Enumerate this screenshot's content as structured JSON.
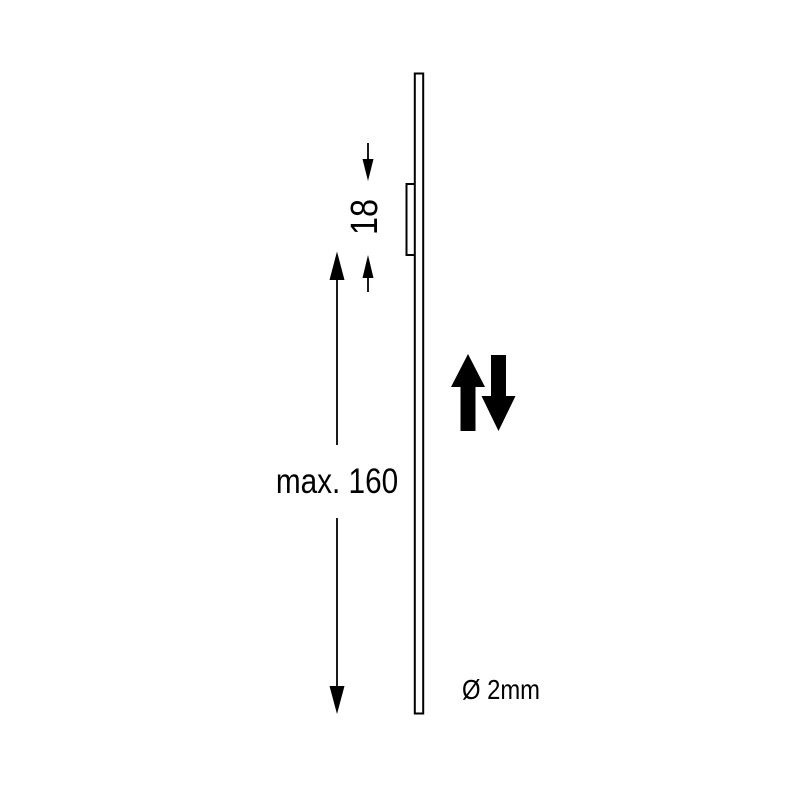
{
  "drawing": {
    "description": "side-view technical drawing of thin plate with clip, vertical travel arrows and dimensions",
    "labels": {
      "bracket_height": "18",
      "max_length": "max. 160",
      "diameter": "Ø 2mm"
    },
    "dimensions": {
      "bracket_height_value": "18",
      "max_length_value": "160",
      "diameter_value": "2mm"
    },
    "icons": {
      "up_arrow": "up-arrow-icon",
      "down_arrow": "down-arrow-icon"
    },
    "colors": {
      "line": "#000000",
      "background": "#ffffff",
      "arrow_fill": "#000000"
    }
  }
}
